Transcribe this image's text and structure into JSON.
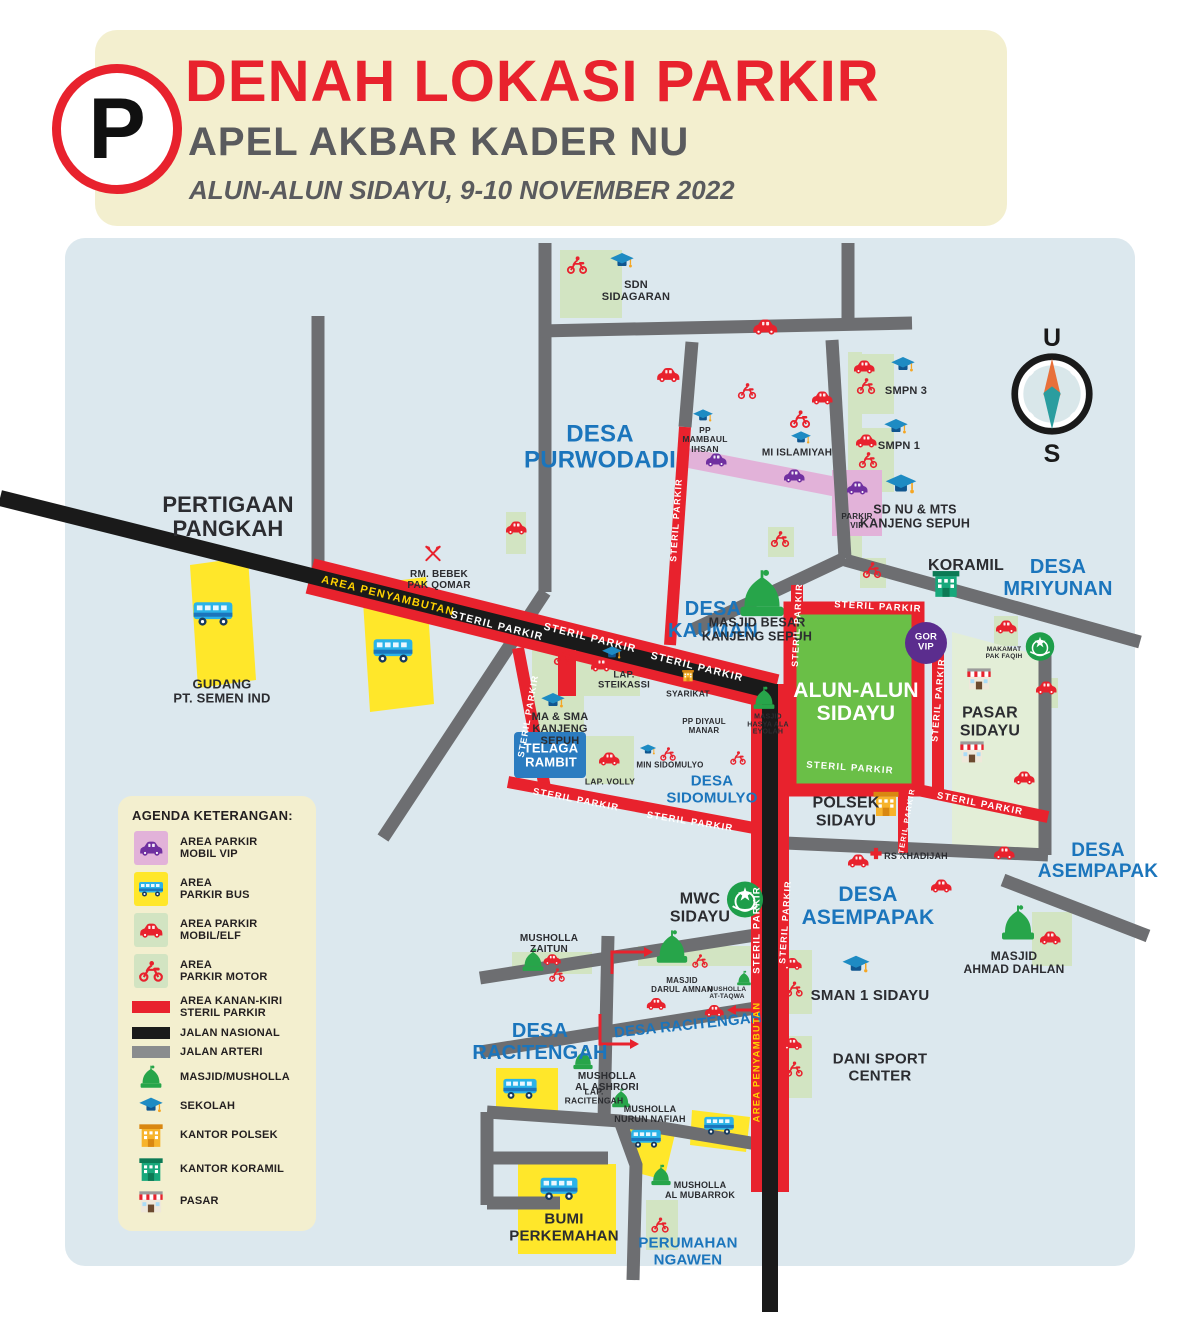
{
  "colors": {
    "accent_red": "#e8222d",
    "label_blue": "#1b75bc",
    "map_bg": "#dce8ee",
    "steril_red": "#e8222d",
    "jalan_nasional": "#1a1a1a",
    "jalan_arteri": "#6d6e71",
    "parkir_green": "#d2e4c2",
    "parkir_yellow": "#ffe72a",
    "parkir_pink": "#e2b2d9",
    "vip_purple": "#7030a0",
    "alun_green": "#6abf47"
  },
  "header": {
    "p_sign": "P",
    "title": "DENAH LOKASI PARKIR",
    "subtitle": "APEL AKBAR KADER NU",
    "date_line": "ALUN-ALUN SIDAYU, 9-10 NOVEMBER 2022"
  },
  "compass": {
    "north": "U",
    "south": "S"
  },
  "legend": {
    "title": "AGENDA KETERANGAN:",
    "items": [
      {
        "swatch": "#e2b2d9",
        "icon": "car",
        "icon_color": "#7030a0",
        "label": "AREA PARKIR\nMOBIL VIP"
      },
      {
        "swatch": "#ffe72a",
        "icon": "bus",
        "icon_color": "",
        "label": "AREA\nPARKIR BUS"
      },
      {
        "swatch": "#d2e4c2",
        "icon": "car",
        "icon_color": "#e8222d",
        "label": "AREA PARKIR\nMOBIL/ELF"
      },
      {
        "swatch": "#d2e4c2",
        "icon": "moto",
        "icon_color": "#e8222d",
        "label": "AREA\nPARKIR MOTOR"
      },
      {
        "bar": "#e8222d",
        "label": "AREA KANAN-KIRI\nSTERIL PARKIR"
      },
      {
        "bar": "#1a1a1a",
        "label": "JALAN NASIONAL"
      },
      {
        "bar": "#8a8c8e",
        "label": "JALAN ARTERI"
      },
      {
        "icon": "mosque",
        "label": "MASJID/MUSHOLLA"
      },
      {
        "icon": "cap",
        "label": "SEKOLAH"
      },
      {
        "icon": "polsek",
        "label": "KANTOR POLSEK"
      },
      {
        "icon": "koramil",
        "label": "KANTOR KORAMIL"
      },
      {
        "icon": "pasar",
        "label": "PASAR"
      }
    ]
  },
  "map": {
    "labels": [
      {
        "t": "DESA\nPURWODADI",
        "x": 600,
        "y": 448,
        "fs": 24,
        "c": "b"
      },
      {
        "t": "DESA\nKAUMAN",
        "x": 713,
        "y": 620,
        "fs": 20,
        "c": "b"
      },
      {
        "t": "DESA\nMRIYUNAN",
        "x": 1058,
        "y": 578,
        "fs": 20,
        "c": "b"
      },
      {
        "t": "DESA\nSIDOMULYO",
        "x": 712,
        "y": 790,
        "fs": 15,
        "c": "b"
      },
      {
        "t": "DESA\nASEMPAPAK",
        "x": 868,
        "y": 906,
        "fs": 21,
        "c": "b"
      },
      {
        "t": "DESA\nASEMPAPAK",
        "x": 1098,
        "y": 862,
        "fs": 19,
        "c": "b"
      },
      {
        "t": "DESA\nRACITENGAH",
        "x": 540,
        "y": 1042,
        "fs": 20,
        "c": "b"
      },
      {
        "t": "DESA RACITENGAH",
        "x": 688,
        "y": 1026,
        "fs": 15,
        "c": "b",
        "rot": -6
      },
      {
        "t": "PERUMAHAN\nNGAWEN",
        "x": 688,
        "y": 1252,
        "fs": 15,
        "c": "b"
      },
      {
        "t": "PERTIGAAN\nPANGKAH",
        "x": 228,
        "y": 517,
        "fs": 22
      },
      {
        "t": "GUDANG\nPT. SEMEN IND",
        "x": 222,
        "y": 692,
        "fs": 13
      },
      {
        "t": "SDN\nSIDAGARAN",
        "x": 636,
        "y": 291,
        "fs": 11
      },
      {
        "t": "RM. BEBEK\nPAK QOMAR",
        "x": 439,
        "y": 580,
        "fs": 10
      },
      {
        "t": "PP\nMAMBAUL\nIHSAN",
        "x": 705,
        "y": 440,
        "fs": 8.5
      },
      {
        "t": "MI ISLAMIYAH",
        "x": 797,
        "y": 453,
        "fs": 10
      },
      {
        "t": "SMPN 3",
        "x": 906,
        "y": 391,
        "fs": 11
      },
      {
        "t": "SMPN 1",
        "x": 899,
        "y": 446,
        "fs": 11
      },
      {
        "t": "PARKIR\nVIP",
        "x": 857,
        "y": 522,
        "fs": 8
      },
      {
        "t": "SD NU & MTS\nKANJENG SEPUH",
        "x": 915,
        "y": 517,
        "fs": 12.5
      },
      {
        "t": "KORAMIL",
        "x": 966,
        "y": 566,
        "fs": 16
      },
      {
        "t": "MASJID BESAR\nKANJENG SEPUH",
        "x": 757,
        "y": 630,
        "fs": 12.5
      },
      {
        "t": "SYARIKAT",
        "x": 688,
        "y": 694,
        "fs": 8.5
      },
      {
        "t": "PP DIYAUL\nMANAR",
        "x": 704,
        "y": 727,
        "fs": 8
      },
      {
        "t": "MASJID\nHASYA ALA\nEYOLAH",
        "x": 768,
        "y": 725,
        "fs": 7
      },
      {
        "t": "MIN SIDOMULYO",
        "x": 670,
        "y": 766,
        "fs": 8
      },
      {
        "t": "MA & SMA\nKANJENG\nSEPUH",
        "x": 560,
        "y": 729,
        "fs": 11
      },
      {
        "t": "LAP.\nSTEIKASSI",
        "x": 624,
        "y": 681,
        "fs": 9.5
      },
      {
        "t": "LAP. VOLLY",
        "x": 610,
        "y": 782,
        "fs": 8.5
      },
      {
        "t": "ALUN-ALUN\nSIDAYU",
        "x": 856,
        "y": 702,
        "fs": 21,
        "c": "w"
      },
      {
        "t": "GOR\nVIP",
        "x": 926,
        "y": 643,
        "fs": 9.5,
        "c": "w"
      },
      {
        "t": "PASAR\nSIDAYU",
        "x": 990,
        "y": 722,
        "fs": 16
      },
      {
        "t": "MAKAMAT\nPAK FAQIH",
        "x": 1004,
        "y": 653,
        "fs": 6.5
      },
      {
        "t": "POLSEK\nSIDAYU",
        "x": 846,
        "y": 812,
        "fs": 16
      },
      {
        "t": "RS KHADIJAH",
        "x": 916,
        "y": 857,
        "fs": 9
      },
      {
        "t": "MWC\nSIDAYU",
        "x": 700,
        "y": 908,
        "fs": 16
      },
      {
        "t": "SMAN 1 SIDAYU",
        "x": 870,
        "y": 996,
        "fs": 15
      },
      {
        "t": "DANI SPORT\nCENTER",
        "x": 880,
        "y": 1068,
        "fs": 15
      },
      {
        "t": "MASJID\nAHMAD DAHLAN",
        "x": 1014,
        "y": 963,
        "fs": 12
      },
      {
        "t": "MUSHOLLA\nZAITUN",
        "x": 549,
        "y": 944,
        "fs": 10
      },
      {
        "t": "MASJID\nDARUL AMNAN",
        "x": 682,
        "y": 986,
        "fs": 8
      },
      {
        "t": "MUSHOLLA\nAT-TAQWA",
        "x": 727,
        "y": 993,
        "fs": 6.5
      },
      {
        "t": "MUSHOLLA\nAL ASHRORI",
        "x": 607,
        "y": 1082,
        "fs": 10
      },
      {
        "t": "LAP.\nRACITENGAH",
        "x": 594,
        "y": 1097,
        "fs": 8.5
      },
      {
        "t": "MUSHOLLA\nNURUN NAFIAH",
        "x": 650,
        "y": 1115,
        "fs": 9
      },
      {
        "t": "MUSHOLLA\nAL MUBARROK",
        "x": 700,
        "y": 1191,
        "fs": 9
      },
      {
        "t": "BUMI\nPERKEMAHAN",
        "x": 564,
        "y": 1228,
        "fs": 15
      },
      {
        "t": "TELAGA\nRAMBIT",
        "x": 551,
        "y": 756,
        "fs": 13,
        "c": "w"
      }
    ],
    "road_labels": [
      {
        "t": "AREA PENYAMBUTAN",
        "x": 388,
        "y": 596,
        "rot": 14,
        "fs": 11,
        "c": "y"
      },
      {
        "t": "STERIL PARKIR",
        "x": 497,
        "y": 626,
        "rot": 14,
        "fs": 10.5,
        "c": "w"
      },
      {
        "t": "STERIL PARKIR",
        "x": 590,
        "y": 638,
        "rot": 14,
        "fs": 10.5,
        "c": "w"
      },
      {
        "t": "STERIL PARKIR",
        "x": 697,
        "y": 667,
        "rot": 14,
        "fs": 10.5,
        "c": "w"
      },
      {
        "t": "STERIL PARKIR",
        "x": 676,
        "y": 520,
        "rot": -86,
        "fs": 9,
        "c": "w"
      },
      {
        "t": "STERIL PARKIR",
        "x": 528,
        "y": 716,
        "rot": -80,
        "fs": 9,
        "c": "w"
      },
      {
        "t": "STERIL PARKIR",
        "x": 576,
        "y": 800,
        "rot": 11,
        "fs": 9.5,
        "c": "w"
      },
      {
        "t": "STERIL PARKIR",
        "x": 690,
        "y": 822,
        "rot": 9,
        "fs": 9.5,
        "c": "w"
      },
      {
        "t": "STERIL PARKIR",
        "x": 797,
        "y": 625,
        "rot": -87,
        "fs": 9,
        "c": "w"
      },
      {
        "t": "STERIL PARKIR",
        "x": 878,
        "y": 607,
        "rot": 3,
        "fs": 9.5,
        "c": "w"
      },
      {
        "t": "STERIL PARKIR",
        "x": 938,
        "y": 700,
        "rot": -85,
        "fs": 9,
        "c": "w"
      },
      {
        "t": "STERIL PARKIR",
        "x": 850,
        "y": 768,
        "rot": 4,
        "fs": 9.5,
        "c": "w"
      },
      {
        "t": "STERIL PARKIR",
        "x": 980,
        "y": 804,
        "rot": 11,
        "fs": 9.5,
        "c": "w"
      },
      {
        "t": "STERIL PARKIR",
        "x": 906,
        "y": 824,
        "rot": -80,
        "fs": 7.5,
        "c": "w"
      },
      {
        "t": "STERIL PARKIR",
        "x": 757,
        "y": 930,
        "rot": -90,
        "fs": 9.5,
        "c": "w"
      },
      {
        "t": "STERIL PARKIR",
        "x": 785,
        "y": 922,
        "rot": -86,
        "fs": 9,
        "c": "w"
      },
      {
        "t": "AREA PENYAMBUTAN",
        "x": 757,
        "y": 1062,
        "rot": -90,
        "fs": 9.5,
        "c": "y"
      }
    ],
    "icons": [
      {
        "k": "cap",
        "x": 622,
        "y": 264,
        "w": 26
      },
      {
        "k": "cap",
        "x": 703,
        "y": 419,
        "w": 22
      },
      {
        "k": "cap",
        "x": 801,
        "y": 441,
        "w": 22
      },
      {
        "k": "cap",
        "x": 903,
        "y": 368,
        "w": 26
      },
      {
        "k": "cap",
        "x": 896,
        "y": 430,
        "w": 26
      },
      {
        "k": "cap",
        "x": 901,
        "y": 488,
        "w": 34
      },
      {
        "k": "cap",
        "x": 553,
        "y": 704,
        "w": 26
      },
      {
        "k": "cap",
        "x": 612,
        "y": 656,
        "w": 22
      },
      {
        "k": "cap",
        "x": 648,
        "y": 753,
        "w": 18
      },
      {
        "k": "cap",
        "x": 856,
        "y": 968,
        "w": 30
      },
      {
        "k": "mosque",
        "x": 762,
        "y": 597,
        "w": 54
      },
      {
        "k": "mosque",
        "x": 764,
        "y": 701,
        "w": 26
      },
      {
        "k": "mosque",
        "x": 672,
        "y": 950,
        "w": 38
      },
      {
        "k": "mosque",
        "x": 533,
        "y": 963,
        "w": 26
      },
      {
        "k": "mosque",
        "x": 744,
        "y": 981,
        "w": 17
      },
      {
        "k": "mosque",
        "x": 583,
        "y": 1062,
        "w": 24
      },
      {
        "k": "mosque",
        "x": 621,
        "y": 1101,
        "w": 22
      },
      {
        "k": "mosque",
        "x": 661,
        "y": 1178,
        "w": 24
      },
      {
        "k": "mosque",
        "x": 1018,
        "y": 926,
        "w": 40
      },
      {
        "k": "car",
        "x": 765,
        "y": 329,
        "w": 28,
        "c": "#e8222d"
      },
      {
        "k": "car",
        "x": 668,
        "y": 377,
        "w": 26,
        "c": "#e8222d"
      },
      {
        "k": "car",
        "x": 516,
        "y": 530,
        "w": 24,
        "c": "#e8222d"
      },
      {
        "k": "car",
        "x": 822,
        "y": 400,
        "w": 24,
        "c": "#e8222d"
      },
      {
        "k": "car",
        "x": 1006,
        "y": 629,
        "w": 24,
        "c": "#e8222d"
      },
      {
        "k": "car",
        "x": 1046,
        "y": 690,
        "w": 24,
        "c": "#e8222d"
      },
      {
        "k": "car",
        "x": 1024,
        "y": 780,
        "w": 24,
        "c": "#e8222d"
      },
      {
        "k": "car",
        "x": 1004,
        "y": 855,
        "w": 24,
        "c": "#e8222d"
      },
      {
        "k": "car",
        "x": 858,
        "y": 863,
        "w": 24,
        "c": "#e8222d"
      },
      {
        "k": "car",
        "x": 941,
        "y": 888,
        "w": 24,
        "c": "#e8222d"
      },
      {
        "k": "car",
        "x": 864,
        "y": 369,
        "w": 24,
        "c": "#e8222d"
      },
      {
        "k": "car",
        "x": 866,
        "y": 443,
        "w": 24,
        "c": "#e8222d"
      },
      {
        "k": "car",
        "x": 792,
        "y": 966,
        "w": 22,
        "c": "#e8222d"
      },
      {
        "k": "car",
        "x": 792,
        "y": 1046,
        "w": 22,
        "c": "#e8222d"
      },
      {
        "k": "car",
        "x": 1050,
        "y": 940,
        "w": 24,
        "c": "#e8222d"
      },
      {
        "k": "car",
        "x": 609,
        "y": 761,
        "w": 24,
        "c": "#e8222d"
      },
      {
        "k": "car",
        "x": 601,
        "y": 667,
        "w": 24,
        "c": "#e8222d"
      },
      {
        "k": "car",
        "x": 552,
        "y": 961,
        "w": 20,
        "c": "#e8222d"
      },
      {
        "k": "car",
        "x": 656,
        "y": 1006,
        "w": 22,
        "c": "#e8222d"
      },
      {
        "k": "car",
        "x": 714,
        "y": 1013,
        "w": 22,
        "c": "#e8222d"
      },
      {
        "k": "moto",
        "x": 577,
        "y": 267,
        "w": 22
      },
      {
        "k": "moto",
        "x": 800,
        "y": 421,
        "w": 22
      },
      {
        "k": "moto",
        "x": 747,
        "y": 393,
        "w": 20
      },
      {
        "k": "moto",
        "x": 866,
        "y": 388,
        "w": 20
      },
      {
        "k": "moto",
        "x": 868,
        "y": 462,
        "w": 20
      },
      {
        "k": "moto",
        "x": 780,
        "y": 541,
        "w": 20
      },
      {
        "k": "moto",
        "x": 872,
        "y": 572,
        "w": 20
      },
      {
        "k": "moto",
        "x": 563,
        "y": 659,
        "w": 20
      },
      {
        "k": "moto",
        "x": 668,
        "y": 756,
        "w": 17
      },
      {
        "k": "moto",
        "x": 738,
        "y": 760,
        "w": 17
      },
      {
        "k": "moto",
        "x": 794,
        "y": 991,
        "w": 19
      },
      {
        "k": "moto",
        "x": 794,
        "y": 1071,
        "w": 19
      },
      {
        "k": "moto",
        "x": 557,
        "y": 977,
        "w": 17
      },
      {
        "k": "moto",
        "x": 700,
        "y": 963,
        "w": 17
      },
      {
        "k": "moto",
        "x": 660,
        "y": 1227,
        "w": 19
      },
      {
        "k": "car",
        "x": 716,
        "y": 462,
        "w": 24,
        "c": "#7030a0"
      },
      {
        "k": "car",
        "x": 794,
        "y": 478,
        "w": 24,
        "c": "#7030a0"
      },
      {
        "k": "car",
        "x": 857,
        "y": 490,
        "w": 24,
        "c": "#7030a0"
      },
      {
        "k": "bus",
        "x": 213,
        "y": 616,
        "w": 42
      },
      {
        "k": "bus",
        "x": 393,
        "y": 653,
        "w": 42
      },
      {
        "k": "bus",
        "x": 520,
        "y": 1091,
        "w": 36
      },
      {
        "k": "bus",
        "x": 646,
        "y": 1141,
        "w": 32
      },
      {
        "k": "bus",
        "x": 719,
        "y": 1128,
        "w": 32
      },
      {
        "k": "bus",
        "x": 559,
        "y": 1191,
        "w": 40
      },
      {
        "k": "polsek",
        "x": 886,
        "y": 806,
        "w": 30
      },
      {
        "k": "polsek",
        "x": 688,
        "y": 678,
        "w": 14
      },
      {
        "k": "koramil",
        "x": 946,
        "y": 586,
        "w": 32
      },
      {
        "k": "pasar",
        "x": 979,
        "y": 681,
        "w": 28
      },
      {
        "k": "pasar",
        "x": 972,
        "y": 754,
        "w": 28
      },
      {
        "k": "cross",
        "x": 876,
        "y": 856,
        "w": 14
      },
      {
        "k": "utensils",
        "x": 433,
        "y": 556,
        "w": 20
      },
      {
        "k": "nu",
        "x": 745,
        "y": 902,
        "w": 38
      },
      {
        "k": "nu",
        "x": 1040,
        "y": 649,
        "w": 30
      }
    ]
  }
}
